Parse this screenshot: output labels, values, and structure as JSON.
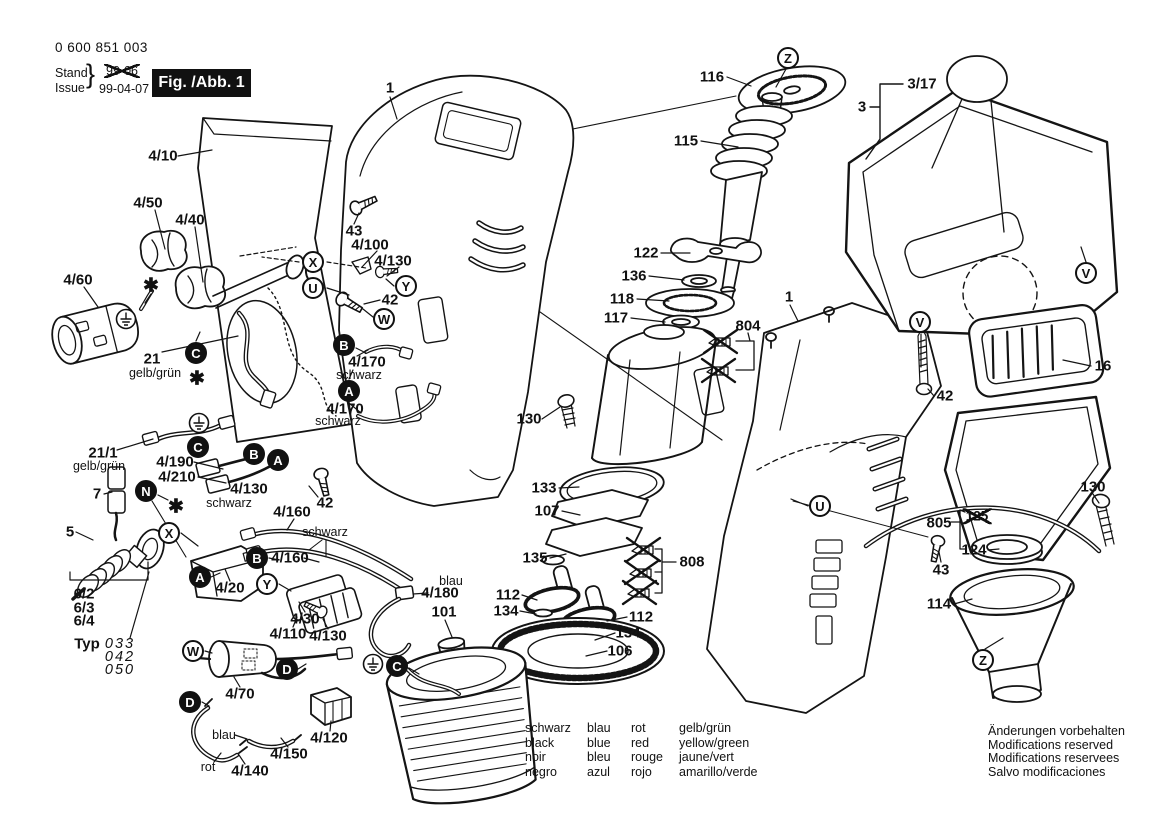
{
  "header": {
    "part_number": "0 600 851 003",
    "stand_label": "Stand",
    "issue_label": "Issue",
    "brace": "}",
    "old_date": "99-06",
    "date": "99-04-07",
    "figure_label": "Fig. /Abb. 1"
  },
  "legend": {
    "rows": [
      [
        "schwarz",
        "blau",
        "rot",
        "gelb/grün"
      ],
      [
        "black",
        "blue",
        "red",
        "yellow/green"
      ],
      [
        "noir",
        "bleu",
        "rouge",
        "jaune/vert"
      ],
      [
        "negro",
        "azul",
        "rojo",
        "amarillo/verde"
      ]
    ]
  },
  "footer_notes": [
    "Änderungen vorbehalten",
    "Modifications reserved",
    "Modifications reservees",
    "Salvo modificaciones"
  ],
  "colors": {
    "ink": "#111111",
    "paper": "#ffffff"
  },
  "diagram": {
    "asterisk_glyph": "✱",
    "labels": [
      {
        "t": "4/10",
        "x": 163,
        "y": 156
      },
      {
        "t": "4/50",
        "x": 148,
        "y": 203
      },
      {
        "t": "4/40",
        "x": 190,
        "y": 220
      },
      {
        "t": "4/60",
        "x": 78,
        "y": 280
      },
      {
        "t": "21",
        "x": 152,
        "y": 359
      },
      {
        "t": "gelb/grün",
        "x": 155,
        "y": 373,
        "s": "color"
      },
      {
        "t": "43",
        "x": 354,
        "y": 231
      },
      {
        "t": "4/100",
        "x": 370,
        "y": 245
      },
      {
        "t": "4/130",
        "x": 393,
        "y": 261
      },
      {
        "t": "42",
        "x": 390,
        "y": 300
      },
      {
        "t": "4/170",
        "x": 367,
        "y": 362
      },
      {
        "t": "schwarz",
        "x": 359,
        "y": 375,
        "s": "color"
      },
      {
        "t": "4/170",
        "x": 345,
        "y": 409
      },
      {
        "t": "schwarz",
        "x": 338,
        "y": 421,
        "s": "color"
      },
      {
        "t": "21/1",
        "x": 103,
        "y": 453
      },
      {
        "t": "gelb/grün",
        "x": 99,
        "y": 466,
        "s": "color"
      },
      {
        "t": "4/190",
        "x": 175,
        "y": 462
      },
      {
        "t": "4/210",
        "x": 177,
        "y": 477
      },
      {
        "t": "4/130",
        "x": 249,
        "y": 489
      },
      {
        "t": "schwarz",
        "x": 229,
        "y": 503,
        "s": "color"
      },
      {
        "t": "7",
        "x": 97,
        "y": 494
      },
      {
        "t": "5",
        "x": 70,
        "y": 532
      },
      {
        "t": "42",
        "x": 325,
        "y": 503
      },
      {
        "t": "4/160",
        "x": 292,
        "y": 512
      },
      {
        "t": "schwarz",
        "x": 325,
        "y": 532,
        "s": "color"
      },
      {
        "t": "4/160",
        "x": 290,
        "y": 558
      },
      {
        "t": "4/20",
        "x": 230,
        "y": 588
      },
      {
        "t": "6/2",
        "x": 84,
        "y": 594
      },
      {
        "t": "6/3",
        "x": 84,
        "y": 608
      },
      {
        "t": "6/4",
        "x": 84,
        "y": 621
      },
      {
        "t": "Typ",
        "x": 87,
        "y": 644,
        "s": "typ"
      },
      {
        "t": "033",
        "x": 120,
        "y": 644,
        "s": "typnum"
      },
      {
        "t": "042",
        "x": 120,
        "y": 657,
        "s": "typnum"
      },
      {
        "t": "050",
        "x": 120,
        "y": 670,
        "s": "typnum"
      },
      {
        "t": "4/30",
        "x": 305,
        "y": 619
      },
      {
        "t": "4/110",
        "x": 288,
        "y": 634
      },
      {
        "t": "4/130",
        "x": 328,
        "y": 636
      },
      {
        "t": "4/70",
        "x": 240,
        "y": 694
      },
      {
        "t": "4/120",
        "x": 329,
        "y": 738
      },
      {
        "t": "4/150",
        "x": 289,
        "y": 754
      },
      {
        "t": "blau",
        "x": 224,
        "y": 735,
        "s": "color"
      },
      {
        "t": "rot",
        "x": 208,
        "y": 767,
        "s": "color"
      },
      {
        "t": "4/140",
        "x": 250,
        "y": 771
      },
      {
        "t": "blau",
        "x": 451,
        "y": 581,
        "s": "color"
      },
      {
        "t": "4/180",
        "x": 440,
        "y": 593
      },
      {
        "t": "101",
        "x": 444,
        "y": 612
      },
      {
        "t": "1",
        "x": 390,
        "y": 88
      },
      {
        "t": "1",
        "x": 789,
        "y": 297
      },
      {
        "t": "116",
        "x": 712,
        "y": 77
      },
      {
        "t": "115",
        "x": 686,
        "y": 141
      },
      {
        "t": "122",
        "x": 646,
        "y": 253
      },
      {
        "t": "136",
        "x": 634,
        "y": 276
      },
      {
        "t": "118",
        "x": 622,
        "y": 299
      },
      {
        "t": "117",
        "x": 616,
        "y": 318
      },
      {
        "t": "804",
        "x": 748,
        "y": 326
      },
      {
        "t": "130",
        "x": 529,
        "y": 419
      },
      {
        "t": "133",
        "x": 544,
        "y": 488
      },
      {
        "t": "107",
        "x": 547,
        "y": 511
      },
      {
        "t": "135",
        "x": 535,
        "y": 558
      },
      {
        "t": "112",
        "x": 508,
        "y": 595
      },
      {
        "t": "134",
        "x": 506,
        "y": 611
      },
      {
        "t": "112",
        "x": 641,
        "y": 617
      },
      {
        "t": "134",
        "x": 628,
        "y": 633
      },
      {
        "t": "106",
        "x": 620,
        "y": 651
      },
      {
        "t": "808",
        "x": 692,
        "y": 562
      },
      {
        "t": "3/17",
        "x": 922,
        "y": 84
      },
      {
        "t": "3",
        "x": 862,
        "y": 107
      },
      {
        "t": "42",
        "x": 945,
        "y": 396
      },
      {
        "t": "16",
        "x": 1103,
        "y": 366
      },
      {
        "t": "130",
        "x": 1093,
        "y": 487
      },
      {
        "t": "805",
        "x": 939,
        "y": 523
      },
      {
        "t": "125",
        "x": 977,
        "y": 516,
        "s": "struck"
      },
      {
        "t": "124",
        "x": 974,
        "y": 550
      },
      {
        "t": "43",
        "x": 941,
        "y": 570
      },
      {
        "t": "114",
        "x": 939,
        "y": 604
      }
    ],
    "callouts": [
      {
        "l": "X",
        "x": 313,
        "y": 262,
        "f": false
      },
      {
        "l": "U",
        "x": 313,
        "y": 288,
        "f": false
      },
      {
        "l": "Y",
        "x": 406,
        "y": 286,
        "f": false
      },
      {
        "l": "W",
        "x": 384,
        "y": 319,
        "f": false
      },
      {
        "l": "X",
        "x": 169,
        "y": 533,
        "f": false
      },
      {
        "l": "Y",
        "x": 267,
        "y": 584,
        "f": false
      },
      {
        "l": "W",
        "x": 193,
        "y": 651,
        "f": false
      },
      {
        "l": "U",
        "x": 820,
        "y": 506,
        "f": false
      },
      {
        "l": "V",
        "x": 920,
        "y": 322,
        "f": false
      },
      {
        "l": "V",
        "x": 1086,
        "y": 273,
        "f": false
      },
      {
        "l": "Z",
        "x": 788,
        "y": 58,
        "f": false
      },
      {
        "l": "Z",
        "x": 983,
        "y": 660,
        "f": false
      },
      {
        "l": "C",
        "x": 196,
        "y": 353,
        "f": true
      },
      {
        "l": "C",
        "x": 198,
        "y": 447,
        "f": true
      },
      {
        "l": "B",
        "x": 344,
        "y": 345,
        "f": true
      },
      {
        "l": "A",
        "x": 349,
        "y": 391,
        "f": true
      },
      {
        "l": "B",
        "x": 254,
        "y": 454,
        "f": true
      },
      {
        "l": "A",
        "x": 278,
        "y": 460,
        "f": true
      },
      {
        "l": "N",
        "x": 146,
        "y": 491,
        "f": true
      },
      {
        "l": "A",
        "x": 200,
        "y": 577,
        "f": true
      },
      {
        "l": "B",
        "x": 257,
        "y": 558,
        "f": true
      },
      {
        "l": "D",
        "x": 287,
        "y": 669,
        "f": true
      },
      {
        "l": "D",
        "x": 190,
        "y": 702,
        "f": true
      },
      {
        "l": "C",
        "x": 397,
        "y": 666,
        "f": true
      }
    ],
    "grounds": [
      {
        "x": 126,
        "y": 319
      },
      {
        "x": 199,
        "y": 423
      },
      {
        "x": 373,
        "y": 664
      }
    ],
    "asterisks": [
      {
        "x": 151,
        "y": 286
      },
      {
        "x": 197,
        "y": 379
      },
      {
        "x": 176,
        "y": 507
      }
    ]
  }
}
